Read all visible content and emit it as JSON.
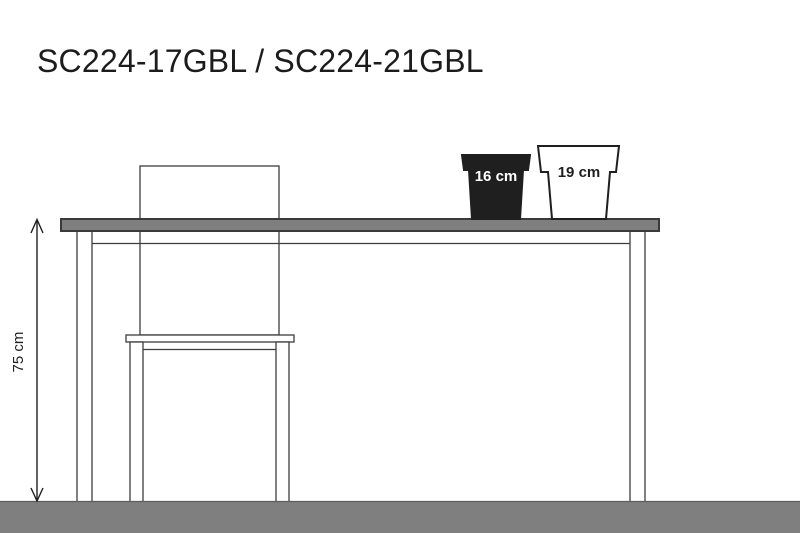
{
  "title": "SC224-17GBL / SC224-21GBL",
  "diagram": {
    "height_label": "75 cm",
    "pots": [
      {
        "label": "16 cm",
        "fill": "#1f1f1f",
        "text_color": "#ffffff"
      },
      {
        "label": "19 cm",
        "fill": "#ffffff",
        "text_color": "#1f1f1f"
      }
    ]
  },
  "colors": {
    "background": "#ffffff",
    "surface_gray": "#7f7f7f",
    "floor_edge": "#5e5e5e",
    "outline_dark": "#3a3a3a",
    "line_black": "#1f1f1f",
    "title_text": "#1c1c1c"
  }
}
